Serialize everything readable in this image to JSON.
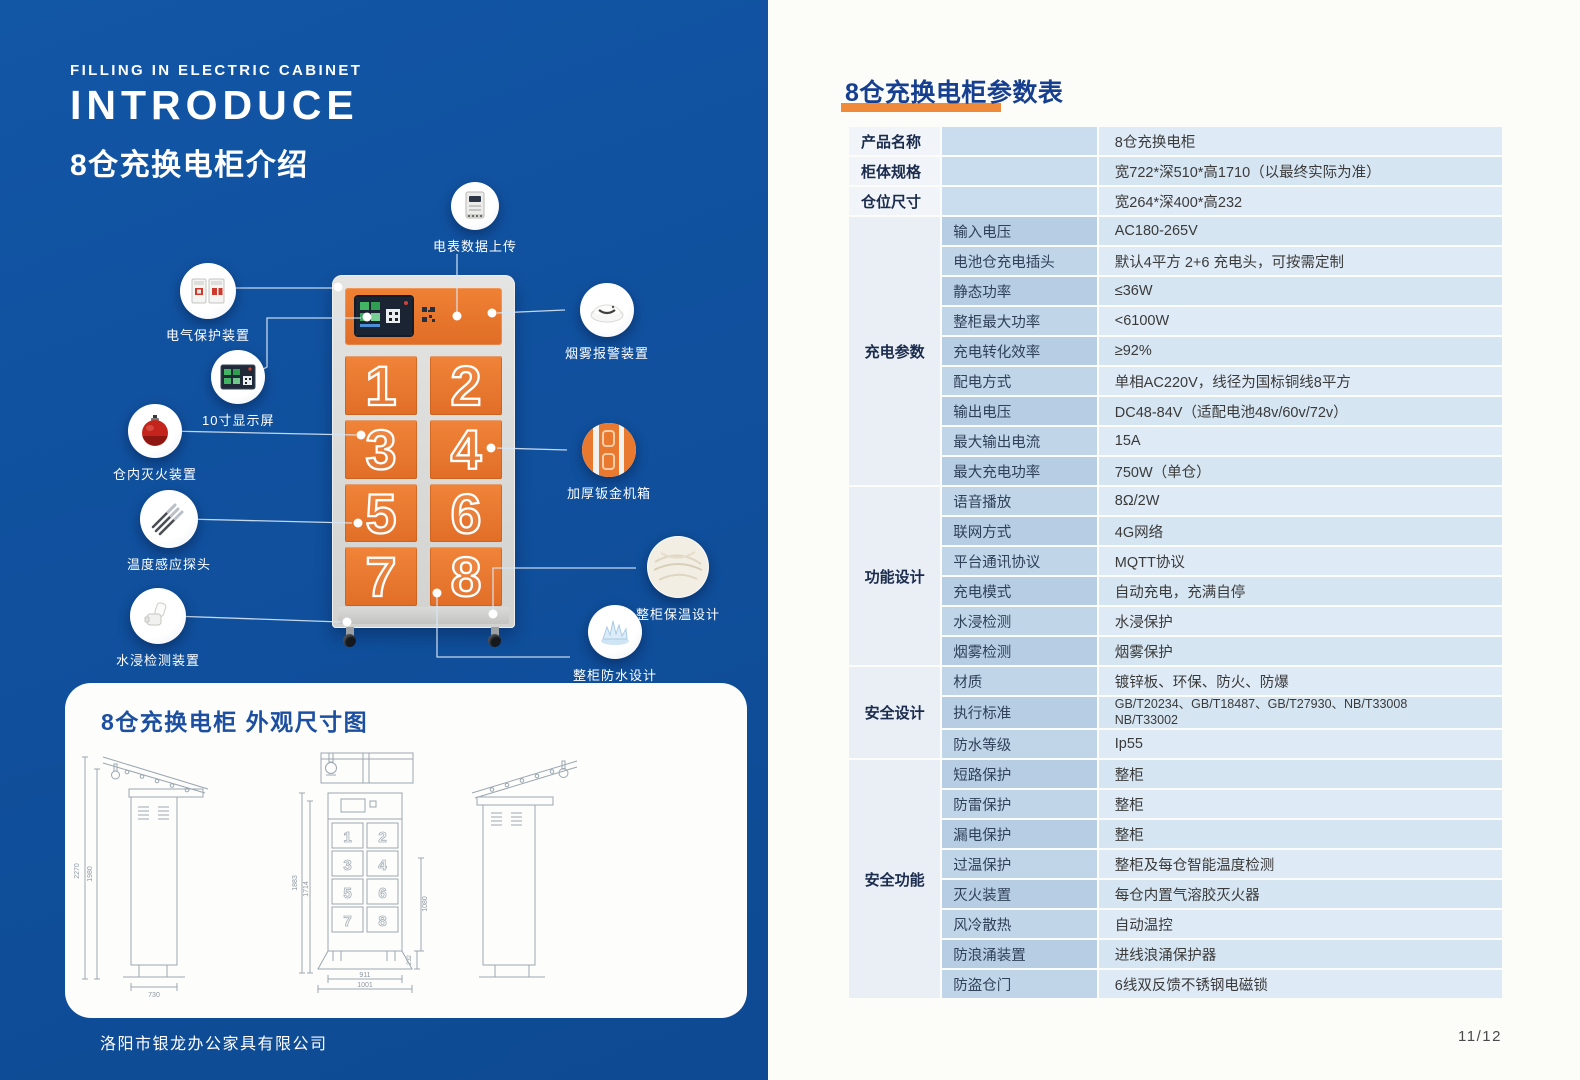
{
  "left": {
    "eyebrow": "FILLING IN ELECTRIC CABINET",
    "title_en": "INTRODUCE",
    "title_zh": "8仓充换电柜介绍",
    "company": "洛阳市银龙办公家具有限公司",
    "cabinet": {
      "doors": [
        "1",
        "2",
        "3",
        "4",
        "5",
        "6",
        "7",
        "8"
      ]
    },
    "callouts": [
      {
        "label": "电表数据上传"
      },
      {
        "label": "电气保护装置"
      },
      {
        "label": "10寸显示屏"
      },
      {
        "label": "仓内灭火装置"
      },
      {
        "label": "温度感应探头"
      },
      {
        "label": "水浸检测装置"
      },
      {
        "label": "烟雾报警装置"
      },
      {
        "label": "加厚钣金机箱"
      },
      {
        "label": "整柜保温设计"
      },
      {
        "label": "整柜防水设计"
      }
    ],
    "dimension_panel": {
      "title": "8仓充换电柜 外观尺寸图",
      "dims": {
        "overall_height": "2270",
        "body_height": "1980",
        "depth": "730",
        "front_height_a": "1883",
        "front_height_b": "1714",
        "door_section_height": "1080",
        "base_height": "232",
        "body_width": "911",
        "base_width": "1001"
      }
    }
  },
  "right": {
    "table_title": "8仓充换电柜参数表",
    "page_number": "11/12",
    "top_rows": [
      {
        "label": "产品名称",
        "value": "8仓充换电柜"
      },
      {
        "label": "柜体规格",
        "value": "宽722*深510*高1710（以最终实际为准）"
      },
      {
        "label": "仓位尺寸",
        "value": "宽264*深400*高232"
      }
    ],
    "groups": [
      {
        "name": "充电参数",
        "rows": [
          {
            "label": "输入电压",
            "value": "AC180-265V"
          },
          {
            "label": "电池仓充电插头",
            "value": "默认4平方 2+6 充电头，可按需定制"
          },
          {
            "label": "静态功率",
            "value": "≤36W"
          },
          {
            "label": "整柜最大功率",
            "value": "<6100W"
          },
          {
            "label": "充电转化效率",
            "value": "≥92%"
          },
          {
            "label": "配电方式",
            "value": "单相AC220V，线径为国标铜线8平方"
          },
          {
            "label": "输出电压",
            "value": "DC48-84V（适配电池48v/60v/72v）"
          },
          {
            "label": "最大输出电流",
            "value": "15A"
          },
          {
            "label": "最大充电功率",
            "value": "750W（单仓）"
          }
        ]
      },
      {
        "name": "功能设计",
        "rows": [
          {
            "label": "语音播放",
            "value": "8Ω/2W"
          },
          {
            "label": "联网方式",
            "value": "4G网络"
          },
          {
            "label": "平台通讯协议",
            "value": "MQTT协议"
          },
          {
            "label": "充电模式",
            "value": "自动充电，充满自停"
          },
          {
            "label": "水浸检测",
            "value": "水浸保护"
          },
          {
            "label": "烟雾检测",
            "value": "烟雾保护"
          }
        ]
      },
      {
        "name": "安全设计",
        "rows": [
          {
            "label": "材质",
            "value": "镀锌板、环保、防火、防爆"
          },
          {
            "label": "执行标准",
            "value": "GB/T20234、GB/T18487、GB/T27930、NB/T33008\nNB/T33002"
          },
          {
            "label": "防水等级",
            "value": "Ip55"
          }
        ]
      },
      {
        "name": "安全功能",
        "rows": [
          {
            "label": "短路保护",
            "value": "整柜"
          },
          {
            "label": "防雷保护",
            "value": "整柜"
          },
          {
            "label": "漏电保护",
            "value": "整柜"
          },
          {
            "label": "过温保护",
            "value": "整柜及每仓智能温度检测"
          },
          {
            "label": "灭火装置",
            "value": "每仓内置气溶胶灭火器"
          },
          {
            "label": "风冷散热",
            "value": "自动温控"
          },
          {
            "label": "防浪涌装置",
            "value": "进线浪涌保护器"
          },
          {
            "label": "防盗仓门",
            "value": "6线双反馈不锈钢电磁锁"
          }
        ]
      }
    ]
  },
  "colors": {
    "brand_blue": "#10509d",
    "accent_orange": "#ee8a3a",
    "door_orange": "#e8772e"
  }
}
